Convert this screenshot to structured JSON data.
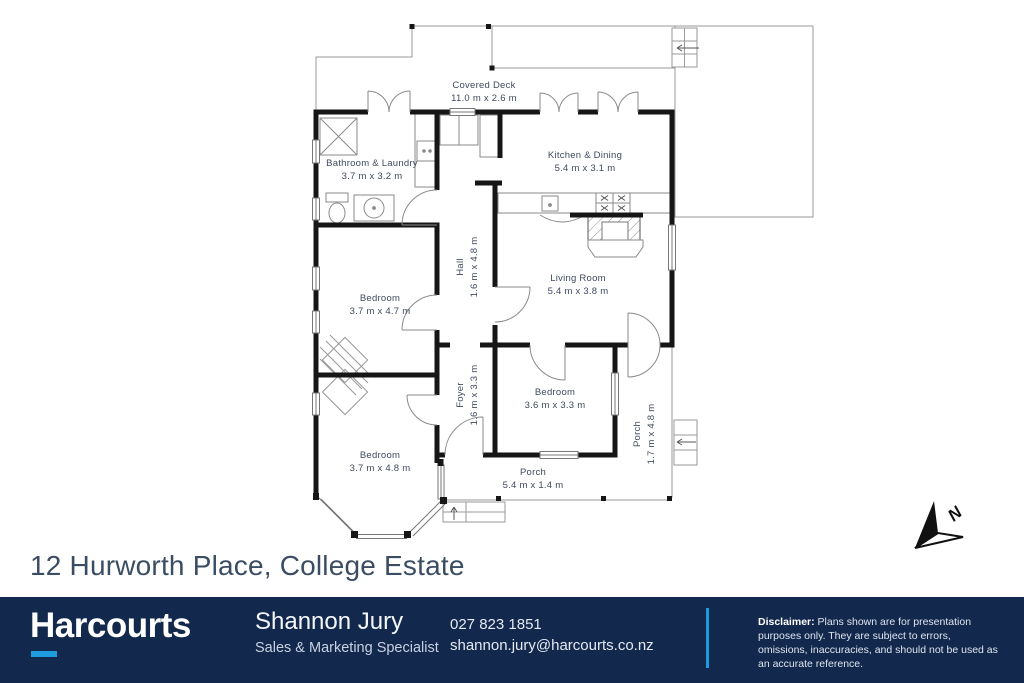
{
  "page": {
    "title": "12 Hurworth Place, College Estate"
  },
  "plan": {
    "north_label": "N",
    "rooms": [
      {
        "id": "covered-deck",
        "name": "Covered Deck",
        "dims": "11.0 m x 2.6 m"
      },
      {
        "id": "bathroom-laundry",
        "name": "Bathroom & Laundry",
        "dims": "3.7 m x 3.2 m"
      },
      {
        "id": "kitchen-dining",
        "name": "Kitchen & Dining",
        "dims": "5.4 m x 3.1 m"
      },
      {
        "id": "hall",
        "name": "Hall",
        "dims": "1.6 m x 4.8 m"
      },
      {
        "id": "living-room",
        "name": "Living Room",
        "dims": "5.4 m x 3.8 m"
      },
      {
        "id": "bedroom-1",
        "name": "Bedroom",
        "dims": "3.7 m x 4.7 m"
      },
      {
        "id": "foyer",
        "name": "Foyer",
        "dims": "1.6 m x 3.3 m"
      },
      {
        "id": "bedroom-2",
        "name": "Bedroom",
        "dims": "3.6 m x 3.3 m"
      },
      {
        "id": "bedroom-3",
        "name": "Bedroom",
        "dims": "3.7 m x 4.8 m"
      },
      {
        "id": "front-porch",
        "name": "Porch",
        "dims": "5.4 m x 1.4 m"
      },
      {
        "id": "side-porch",
        "name": "Porch",
        "dims": "1.7 m x 4.8 m"
      }
    ]
  },
  "footer": {
    "brand": "Harcourts",
    "agent_name": "Shannon Jury",
    "agent_role": "Sales & Marketing Specialist",
    "phone": "027 823 1851",
    "email": "shannon.jury@harcourts.co.nz",
    "disclaimer_label": "Disclaimer:",
    "disclaimer_text": " Plans shown are for presentation purposes only.  They are subject to errors, omissions, inaccuracies, and should not be used as an accurate reference."
  },
  "colors": {
    "brand_navy": "#13284d",
    "accent_blue": "#1d9de0",
    "plan_text": "#3f4a5e",
    "title_text": "#3a4d63",
    "wall": "#161616",
    "outline_gray": "#9a9a9a"
  }
}
